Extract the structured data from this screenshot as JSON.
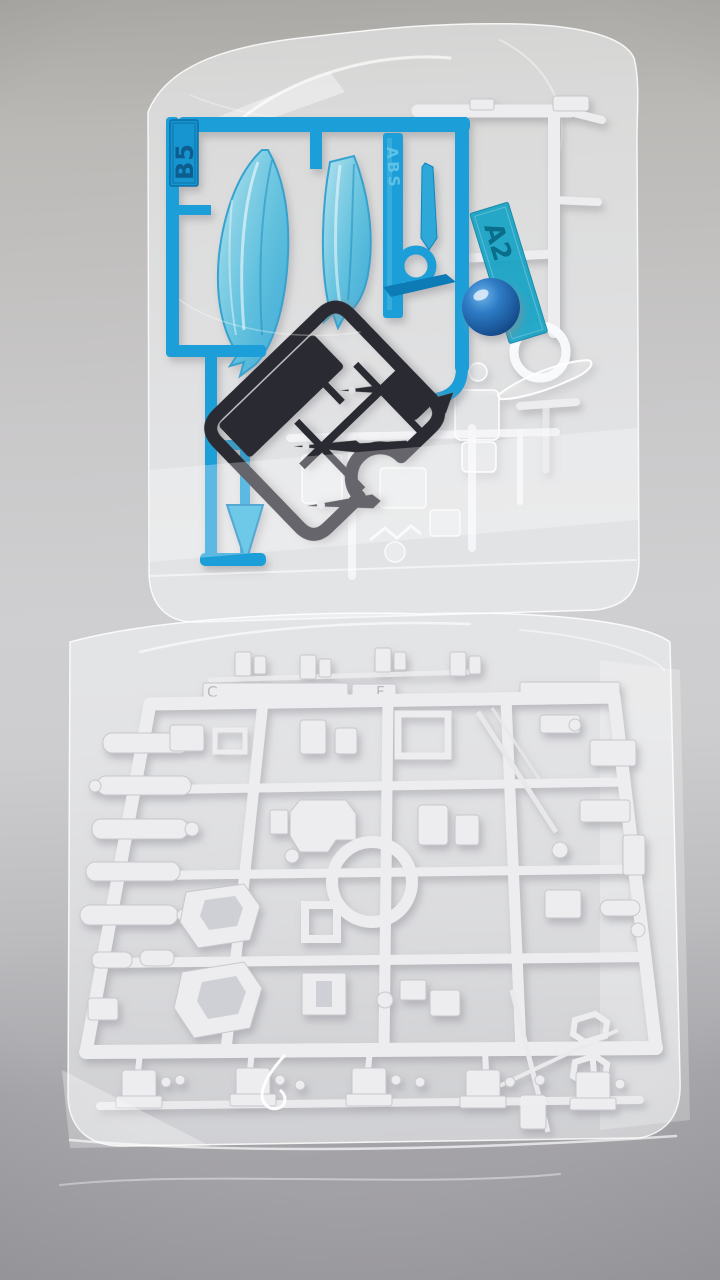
{
  "labels": {
    "blue_runner_tag": "B5",
    "material_marking": "ABS",
    "clear_runner_tag": "A2",
    "white_runner_tag_left": "C",
    "white_runner_tag_right": "F"
  },
  "colors": {
    "background_top": "#a9a7a3",
    "background_mid": "#cfcfd1",
    "background_bottom": "#a7a6aa",
    "bag_film": "#f3f4f7",
    "blue_runner": "#1f9fd8",
    "blue_runner_deep": "#0f7cb6",
    "blue_part_light": "#7dd2ea",
    "teal_tag": "#18a3c6",
    "black_runner": "#2c2c30",
    "white_runner": "#ededef",
    "white_runner_shadow": "#c8c8cc",
    "sphere_blue": "#1d63b2"
  }
}
